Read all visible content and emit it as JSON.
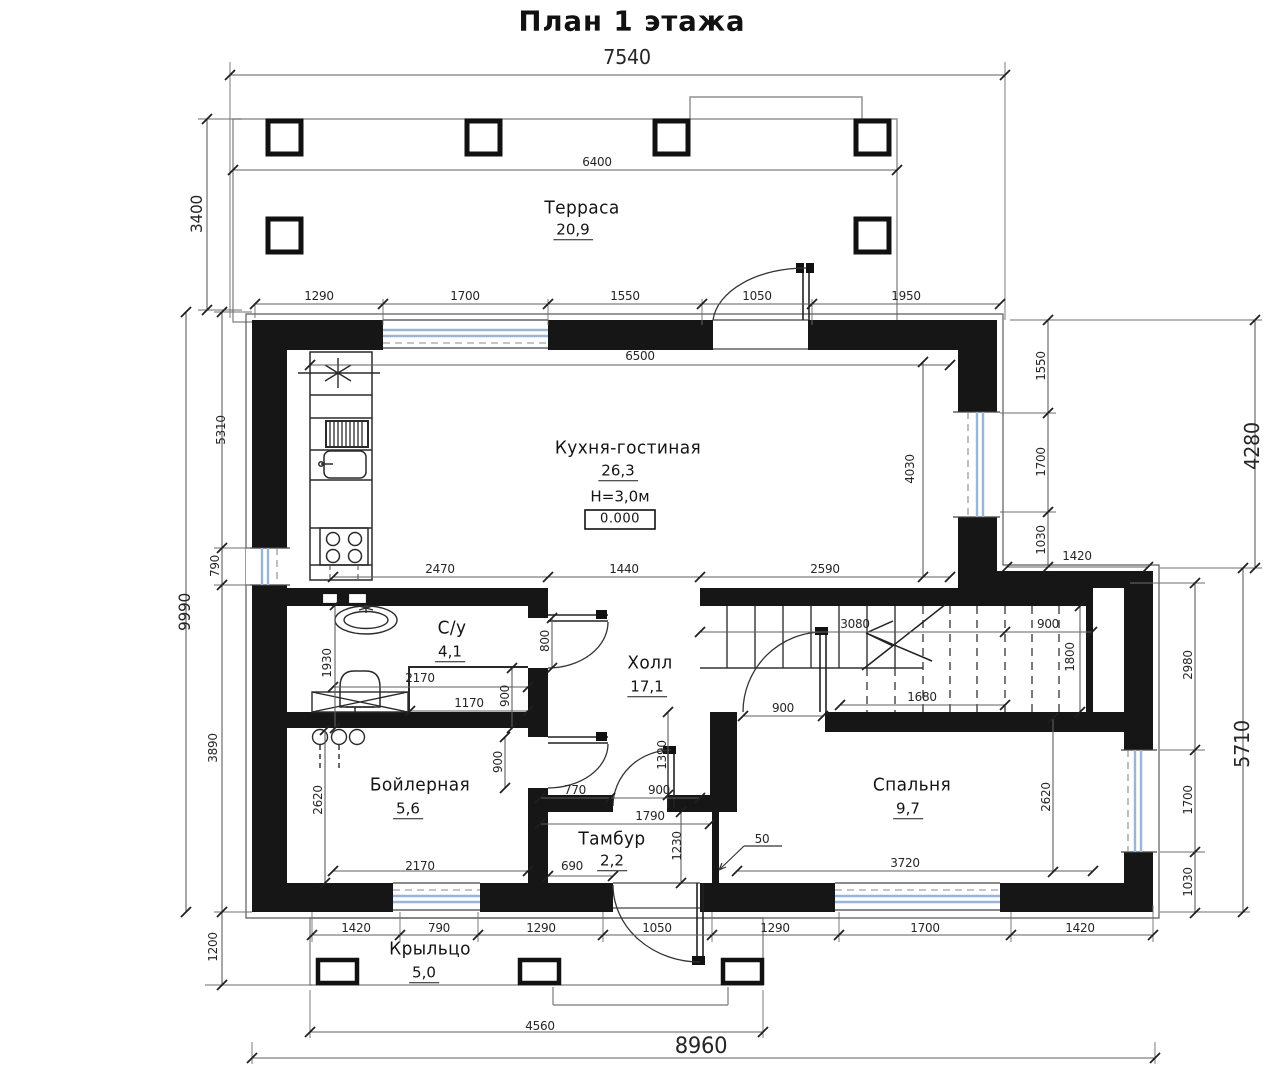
{
  "title": "План 1 этажа",
  "colors": {
    "wall": "#161616",
    "thin_line": "#6b6b6b",
    "dim_line": "#5f5f5f",
    "tick": "#1f1f1f",
    "window_glass": "#9bb5d8",
    "text": "#262626",
    "background": "#ffffff"
  },
  "rooms": [
    {
      "name": "Терраса",
      "area": "20,9",
      "nx": 582,
      "ny": 209,
      "ax": 573,
      "ay": 231
    },
    {
      "name": "Кухня-гостиная",
      "area": "26,3",
      "nx": 628,
      "ny": 449,
      "ax": 618,
      "ay": 472,
      "height_label": "H=3,0м",
      "hx": 620,
      "hy": 497,
      "elevation": "0.000",
      "ex": 620,
      "ey": 519
    },
    {
      "name": "С/у",
      "area": "4,1",
      "nx": 452,
      "ny": 629,
      "ax": 450,
      "ay": 653
    },
    {
      "name": "Холл",
      "area": "17,1",
      "nx": 650,
      "ny": 664,
      "ax": 647,
      "ay": 688
    },
    {
      "name": "Бойлерная",
      "area": "5,6",
      "nx": 420,
      "ny": 786,
      "ax": 408,
      "ay": 810
    },
    {
      "name": "Тамбур",
      "area": "2,2",
      "nx": 612,
      "ny": 840,
      "ax": 612,
      "ay": 862
    },
    {
      "name": "Спальня",
      "area": "9,7",
      "nx": 912,
      "ny": 786,
      "ax": 908,
      "ay": 810
    },
    {
      "name": "Крыльцо",
      "area": "5,0",
      "nx": 430,
      "ny": 950,
      "ax": 424,
      "ay": 974
    }
  ],
  "dimension_labels": [
    {
      "t": "7540",
      "x": 627,
      "y": 57,
      "s": 20
    },
    {
      "t": "3400",
      "x": 197,
      "y": 214,
      "r": 1,
      "s": 16
    },
    {
      "t": "6400",
      "x": 597,
      "y": 162
    },
    {
      "t": "1290",
      "x": 319,
      "y": 296
    },
    {
      "t": "1700",
      "x": 465,
      "y": 296
    },
    {
      "t": "1550",
      "x": 625,
      "y": 296
    },
    {
      "t": "1050",
      "x": 757,
      "y": 296
    },
    {
      "t": "1950",
      "x": 906,
      "y": 296
    },
    {
      "t": "9990",
      "x": 185,
      "y": 612,
      "r": 1,
      "s": 16
    },
    {
      "t": "5310",
      "x": 221,
      "y": 430,
      "r": 1
    },
    {
      "t": "790",
      "x": 215,
      "y": 566,
      "r": 1
    },
    {
      "t": "3890",
      "x": 213,
      "y": 748,
      "r": 1
    },
    {
      "t": "1200",
      "x": 213,
      "y": 947,
      "r": 1
    },
    {
      "t": "6500",
      "x": 640,
      "y": 356
    },
    {
      "t": "4030",
      "x": 910,
      "y": 469,
      "r": 1
    },
    {
      "t": "1550",
      "x": 1041,
      "y": 366,
      "r": 1
    },
    {
      "t": "1700",
      "x": 1041,
      "y": 462,
      "r": 1
    },
    {
      "t": "1030",
      "x": 1041,
      "y": 540,
      "r": 1
    },
    {
      "t": "1420",
      "x": 1077,
      "y": 556
    },
    {
      "t": "4280",
      "x": 1252,
      "y": 446,
      "r": 1,
      "s": 20
    },
    {
      "t": "2470",
      "x": 440,
      "y": 569
    },
    {
      "t": "1440",
      "x": 624,
      "y": 569
    },
    {
      "t": "2590",
      "x": 825,
      "y": 569
    },
    {
      "t": "1930",
      "x": 327,
      "y": 663,
      "r": 1
    },
    {
      "t": "800",
      "x": 545,
      "y": 641,
      "r": 1
    },
    {
      "t": "2170",
      "x": 420,
      "y": 678
    },
    {
      "t": "1170",
      "x": 469,
      "y": 703
    },
    {
      "t": "900",
      "x": 505,
      "y": 696,
      "r": 1
    },
    {
      "t": "3080",
      "x": 855,
      "y": 624
    },
    {
      "t": "900",
      "x": 1048,
      "y": 624
    },
    {
      "t": "1680",
      "x": 922,
      "y": 697
    },
    {
      "t": "1800",
      "x": 1070,
      "y": 657,
      "r": 1
    },
    {
      "t": "900",
      "x": 783,
      "y": 708
    },
    {
      "t": "2980",
      "x": 1188,
      "y": 665,
      "r": 1
    },
    {
      "t": "1700",
      "x": 1188,
      "y": 800,
      "r": 1
    },
    {
      "t": "1030",
      "x": 1188,
      "y": 882,
      "r": 1
    },
    {
      "t": "5710",
      "x": 1242,
      "y": 744,
      "r": 1,
      "s": 20
    },
    {
      "t": "2620",
      "x": 1046,
      "y": 797,
      "r": 1
    },
    {
      "t": "2620",
      "x": 318,
      "y": 800,
      "r": 1
    },
    {
      "t": "900",
      "x": 498,
      "y": 762,
      "r": 1
    },
    {
      "t": "770",
      "x": 575,
      "y": 790
    },
    {
      "t": "900",
      "x": 659,
      "y": 790
    },
    {
      "t": "1390",
      "x": 662,
      "y": 755,
      "r": 1
    },
    {
      "t": "1790",
      "x": 650,
      "y": 816
    },
    {
      "t": "1230",
      "x": 677,
      "y": 846,
      "r": 1
    },
    {
      "t": "690",
      "x": 572,
      "y": 866
    },
    {
      "t": "2170",
      "x": 420,
      "y": 866
    },
    {
      "t": "50",
      "x": 762,
      "y": 839
    },
    {
      "t": "3720",
      "x": 905,
      "y": 863
    },
    {
      "t": "1420",
      "x": 356,
      "y": 928
    },
    {
      "t": "790",
      "x": 439,
      "y": 928
    },
    {
      "t": "1290",
      "x": 541,
      "y": 928
    },
    {
      "t": "1050",
      "x": 657,
      "y": 928
    },
    {
      "t": "1290",
      "x": 775,
      "y": 928
    },
    {
      "t": "1700",
      "x": 925,
      "y": 928
    },
    {
      "t": "1420",
      "x": 1080,
      "y": 928
    },
    {
      "t": "4560",
      "x": 540,
      "y": 1026
    },
    {
      "t": "8960",
      "x": 701,
      "y": 1047,
      "s": 22
    }
  ]
}
